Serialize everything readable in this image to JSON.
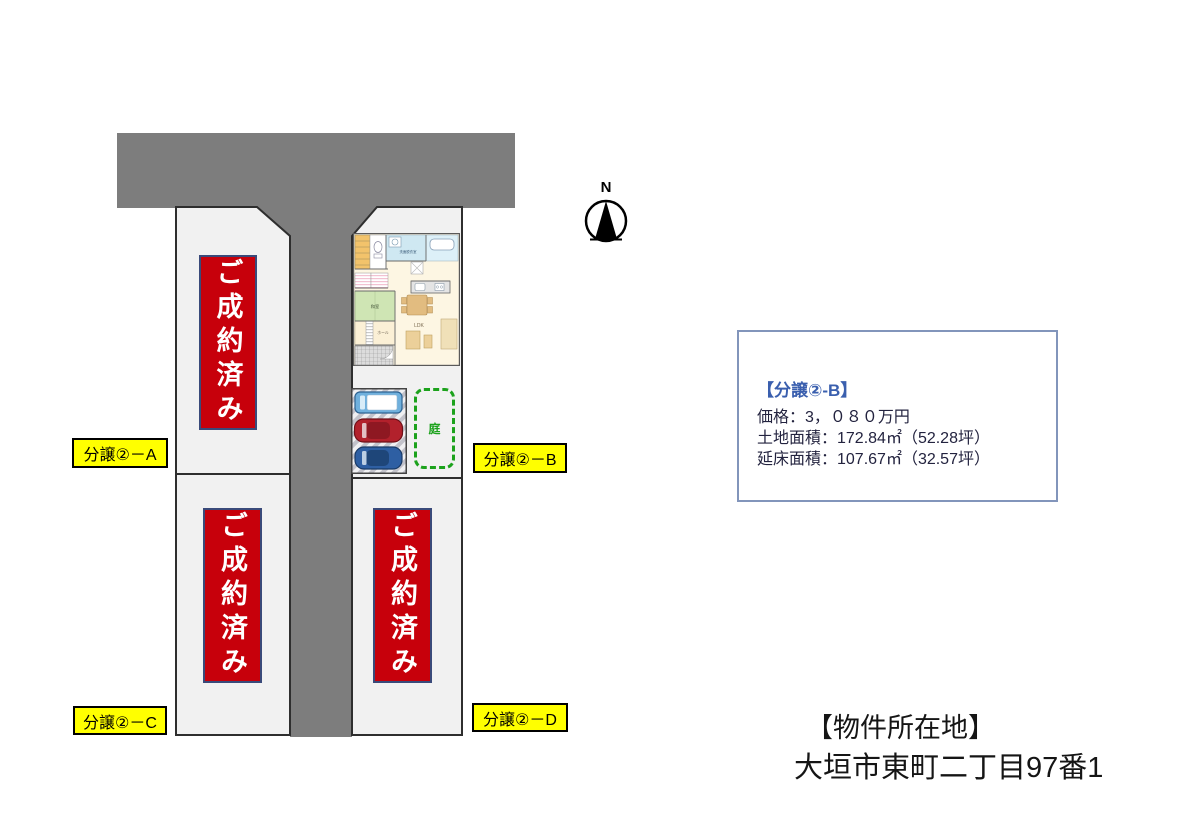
{
  "site": {
    "compass": {
      "label": "N"
    },
    "lots": {
      "a": {
        "tag": "分譲②－A",
        "status": "ご成約済み"
      },
      "b": {
        "tag": "分譲②－B"
      },
      "c": {
        "tag": "分譲②－C",
        "status": "ご成約済み"
      },
      "d": {
        "tag": "分譲②－D",
        "status": "ご成約済み"
      }
    },
    "floor_plan": {
      "washroom": "洗面脱衣室",
      "tatami": "和室",
      "hall": "ホール",
      "entrance": "玄関",
      "ldk": "LDK",
      "garden": "庭"
    }
  },
  "info_box": {
    "title": "【分譲②-B】",
    "price": "価格：3，０８０万円",
    "land_area": "土地面積：172.84㎡（52.28坪）",
    "floor_area": "延床面積：107.67㎡（32.57坪）"
  },
  "location": {
    "heading": "【物件所在地】",
    "address": "大垣市東町二丁目97番1"
  },
  "colors": {
    "road": "#7d7d7d",
    "lot_fill": "#f1f1f1",
    "sold_red": "#c7000b",
    "tag_yellow": "#ffff00",
    "garden_green": "#1ca21c",
    "info_border": "#8295bb",
    "info_title_blue": "#3a5fae"
  }
}
